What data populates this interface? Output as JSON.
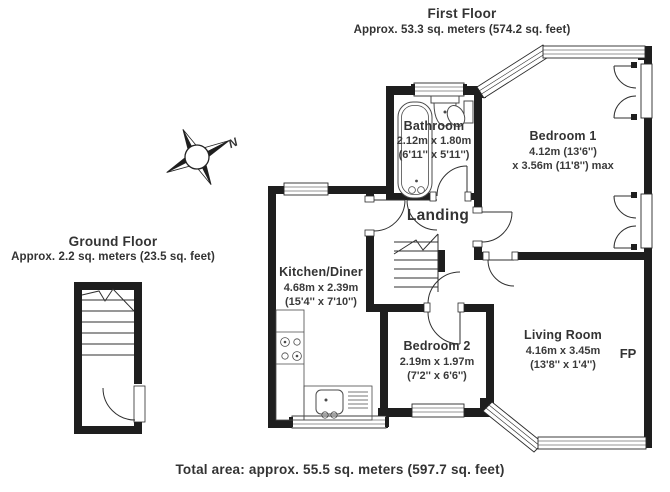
{
  "first_floor": {
    "title": "First Floor",
    "subtitle": "Approx. 53.3 sq. meters (574.2 sq. feet)"
  },
  "ground_floor": {
    "title": "Ground Floor",
    "subtitle": "Approx. 2.2 sq. meters (23.5 sq. feet)"
  },
  "compass": {
    "n": "N"
  },
  "rooms": {
    "bathroom": {
      "name": "Bathroom",
      "dims_metric": "2.12m x 1.80m",
      "dims_imperial": "(6'11'' x 5'11'')"
    },
    "bedroom1": {
      "name": "Bedroom 1",
      "dims_metric": "4.12m (13'6'')",
      "dims_imperial": "x 3.56m (11'8'') max"
    },
    "landing": {
      "name": "Landing"
    },
    "kitchen": {
      "name": "Kitchen/Diner",
      "dims_metric": "4.68m x 2.39m",
      "dims_imperial": "(15'4'' x 7'10'')"
    },
    "bedroom2": {
      "name": "Bedroom 2",
      "dims_metric": "2.19m x 1.97m",
      "dims_imperial": "(7'2'' x 6'6'')"
    },
    "living_room": {
      "name": "Living Room",
      "dims_metric": "4.16m x 3.45m",
      "dims_imperial": "(13'8'' x 1'4'')"
    },
    "fireplace": {
      "label": "FP"
    }
  },
  "footer": {
    "total": "Total area: approx. 55.5 sq. meters (597.7 sq. feet)"
  },
  "colors": {
    "wall": "#1e1e1e",
    "text": "#333333"
  }
}
